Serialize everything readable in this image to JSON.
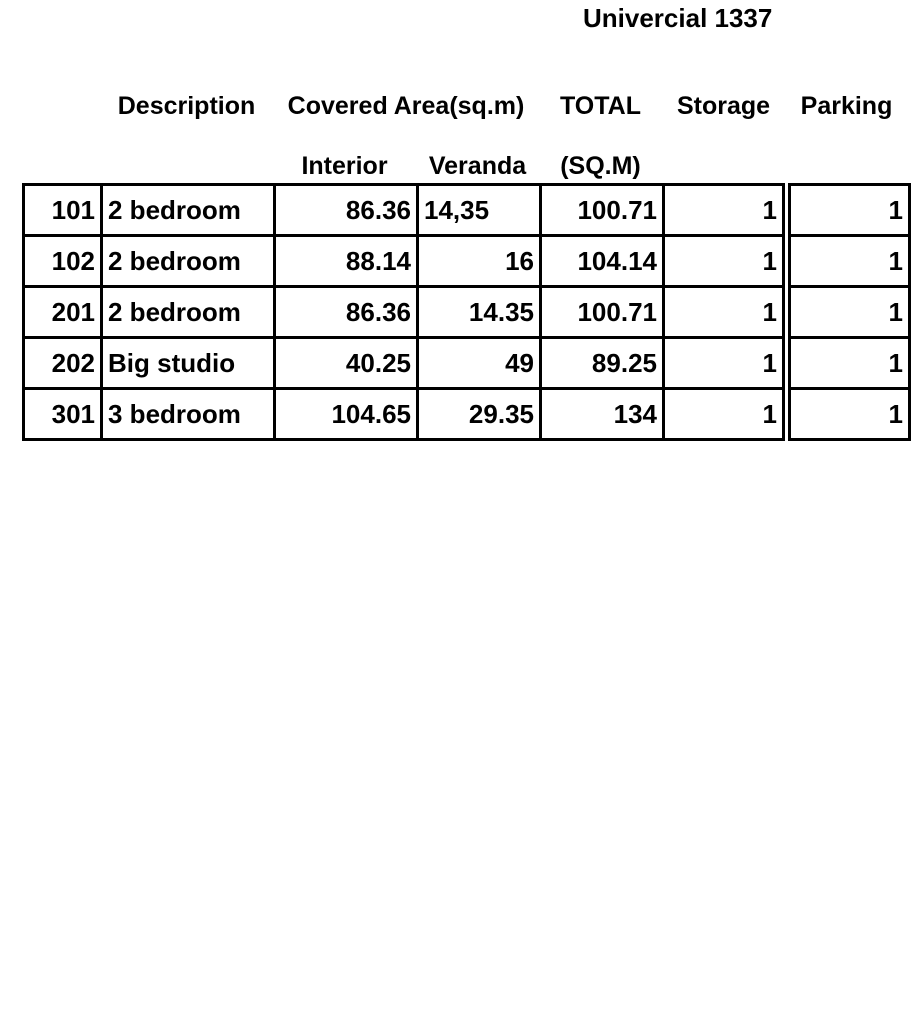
{
  "title": "Univercial 1337",
  "table": {
    "header_row1": {
      "description": "Description",
      "covered_area": "Covered Area(sq.m)",
      "total": "TOTAL",
      "storage": "Storage",
      "parking": "Parking"
    },
    "header_row2": {
      "interior": "Interior",
      "veranda": "Veranda",
      "sqm": "(SQ.M)"
    },
    "rows": [
      {
        "unit": "101",
        "description": "2 bedroom",
        "interior": "86.36",
        "veranda": "14,35",
        "total": "100.71",
        "storage": "1",
        "parking": "1"
      },
      {
        "unit": "102",
        "description": "2 bedroom",
        "interior": "88.14",
        "veranda": "16",
        "total": "104.14",
        "storage": "1",
        "parking": "1"
      },
      {
        "unit": "201",
        "description": "2 bedroom",
        "interior": "86.36",
        "veranda": "14.35",
        "total": "100.71",
        "storage": "1",
        "parking": "1"
      },
      {
        "unit": "202",
        "description": "Big studio",
        "interior": "40.25",
        "veranda": "49",
        "total": "89.25",
        "storage": "1",
        "parking": "1"
      },
      {
        "unit": "301",
        "description": "3 bedroom",
        "interior": "104.65",
        "veranda": "29.35",
        "total": "134",
        "storage": "1",
        "parking": "1"
      }
    ]
  },
  "colors": {
    "text": "#000000",
    "border": "#000000",
    "background": "#ffffff"
  }
}
